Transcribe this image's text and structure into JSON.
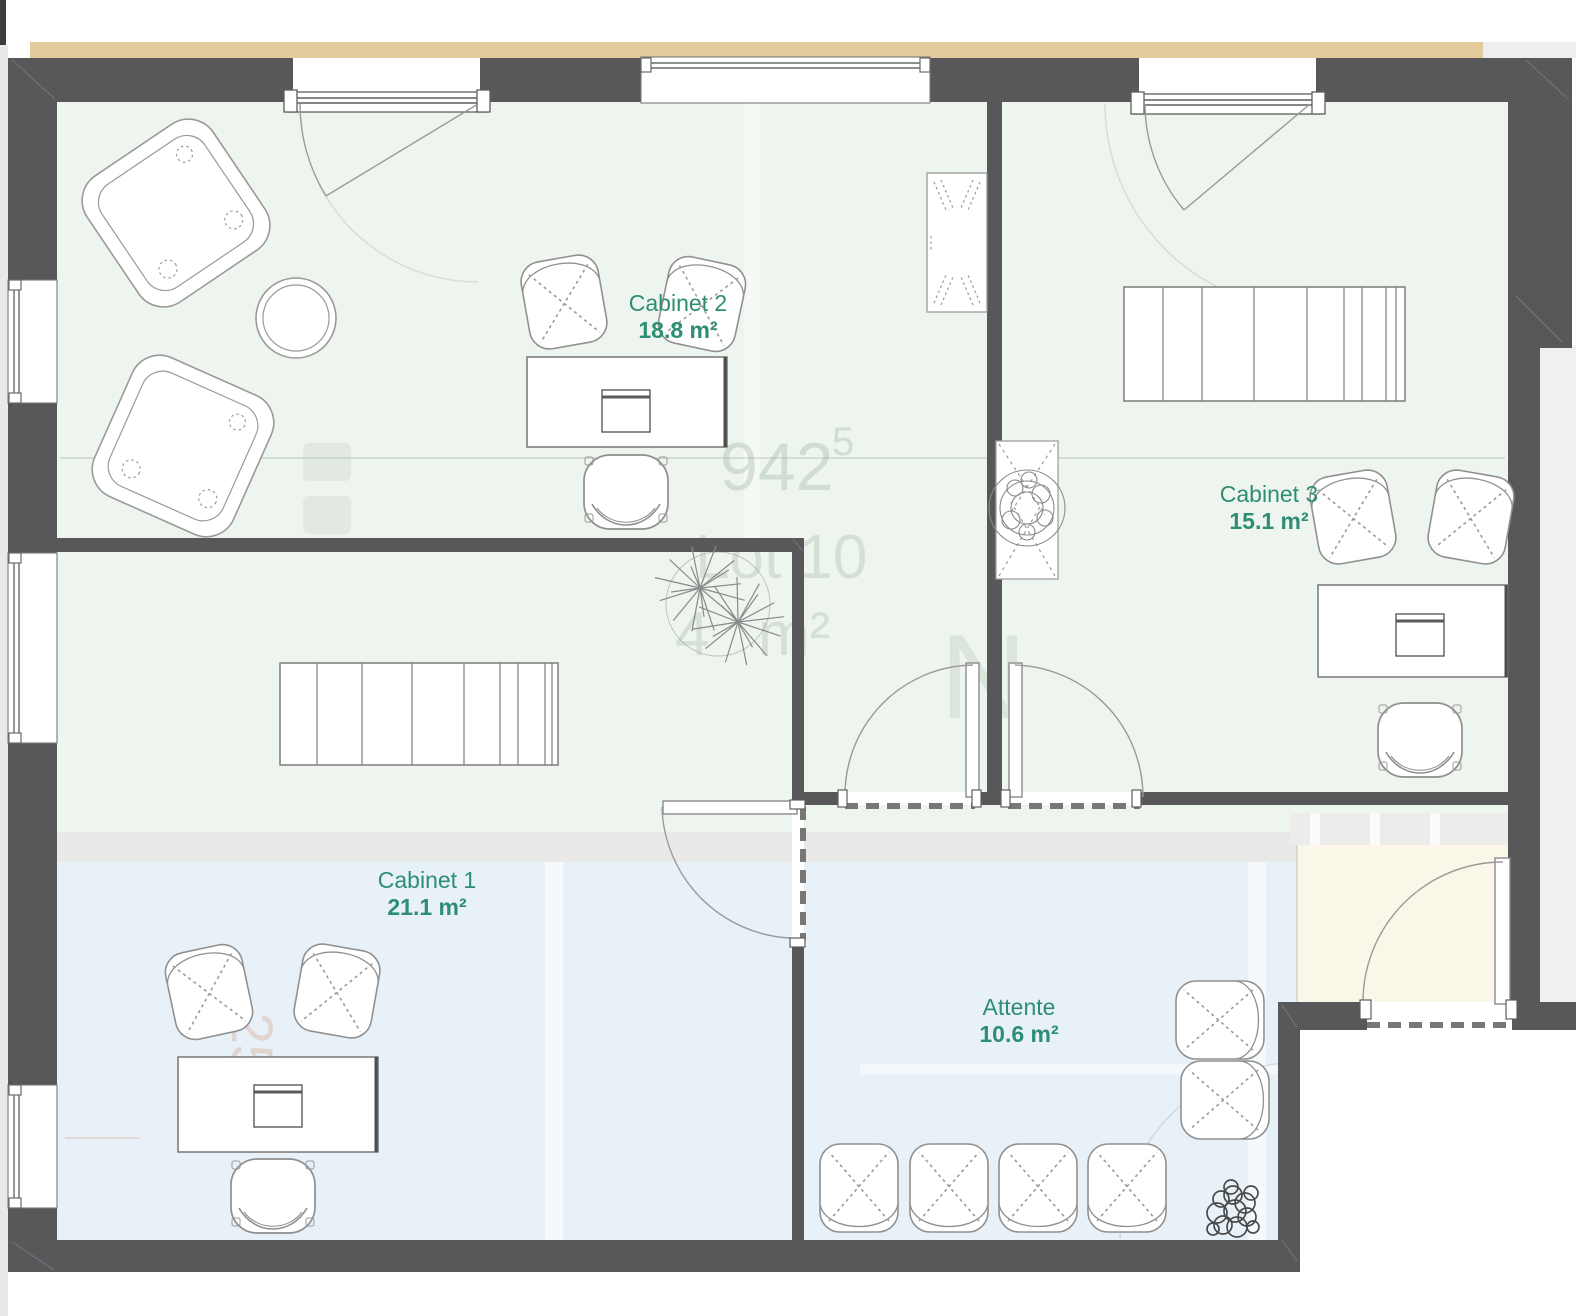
{
  "page": {
    "kind": "floor-plan",
    "description": "Office floor plan with three consulting rooms and a waiting room"
  },
  "rooms": [
    {
      "name": "Cabinet 2",
      "area": "18.8 m²"
    },
    {
      "name": "Cabinet 3",
      "area": "15.1 m²"
    },
    {
      "name": "Cabinet 1",
      "area": "21.1 m²"
    },
    {
      "name": "Attente",
      "area": "10.6 m²"
    }
  ],
  "underlay": {
    "dimension_number": "942",
    "dimension_superscript": "5",
    "lot_label": "Lot 10",
    "area_fragment_left": "4",
    "area_fragment_right": "m²",
    "side_dimension": "257",
    "partial_glyph": "N"
  },
  "colors": {
    "wall": "#58585a",
    "room_green": "#edf5ee",
    "room_blue": "#e8f1f7",
    "entry_cream": "#faf7e9",
    "old_wall_band": "#e9e9e7",
    "exterior_beige": "#e3cb9b",
    "label_text": "#2d8e74",
    "furniture_line": "#8f8f8f"
  }
}
